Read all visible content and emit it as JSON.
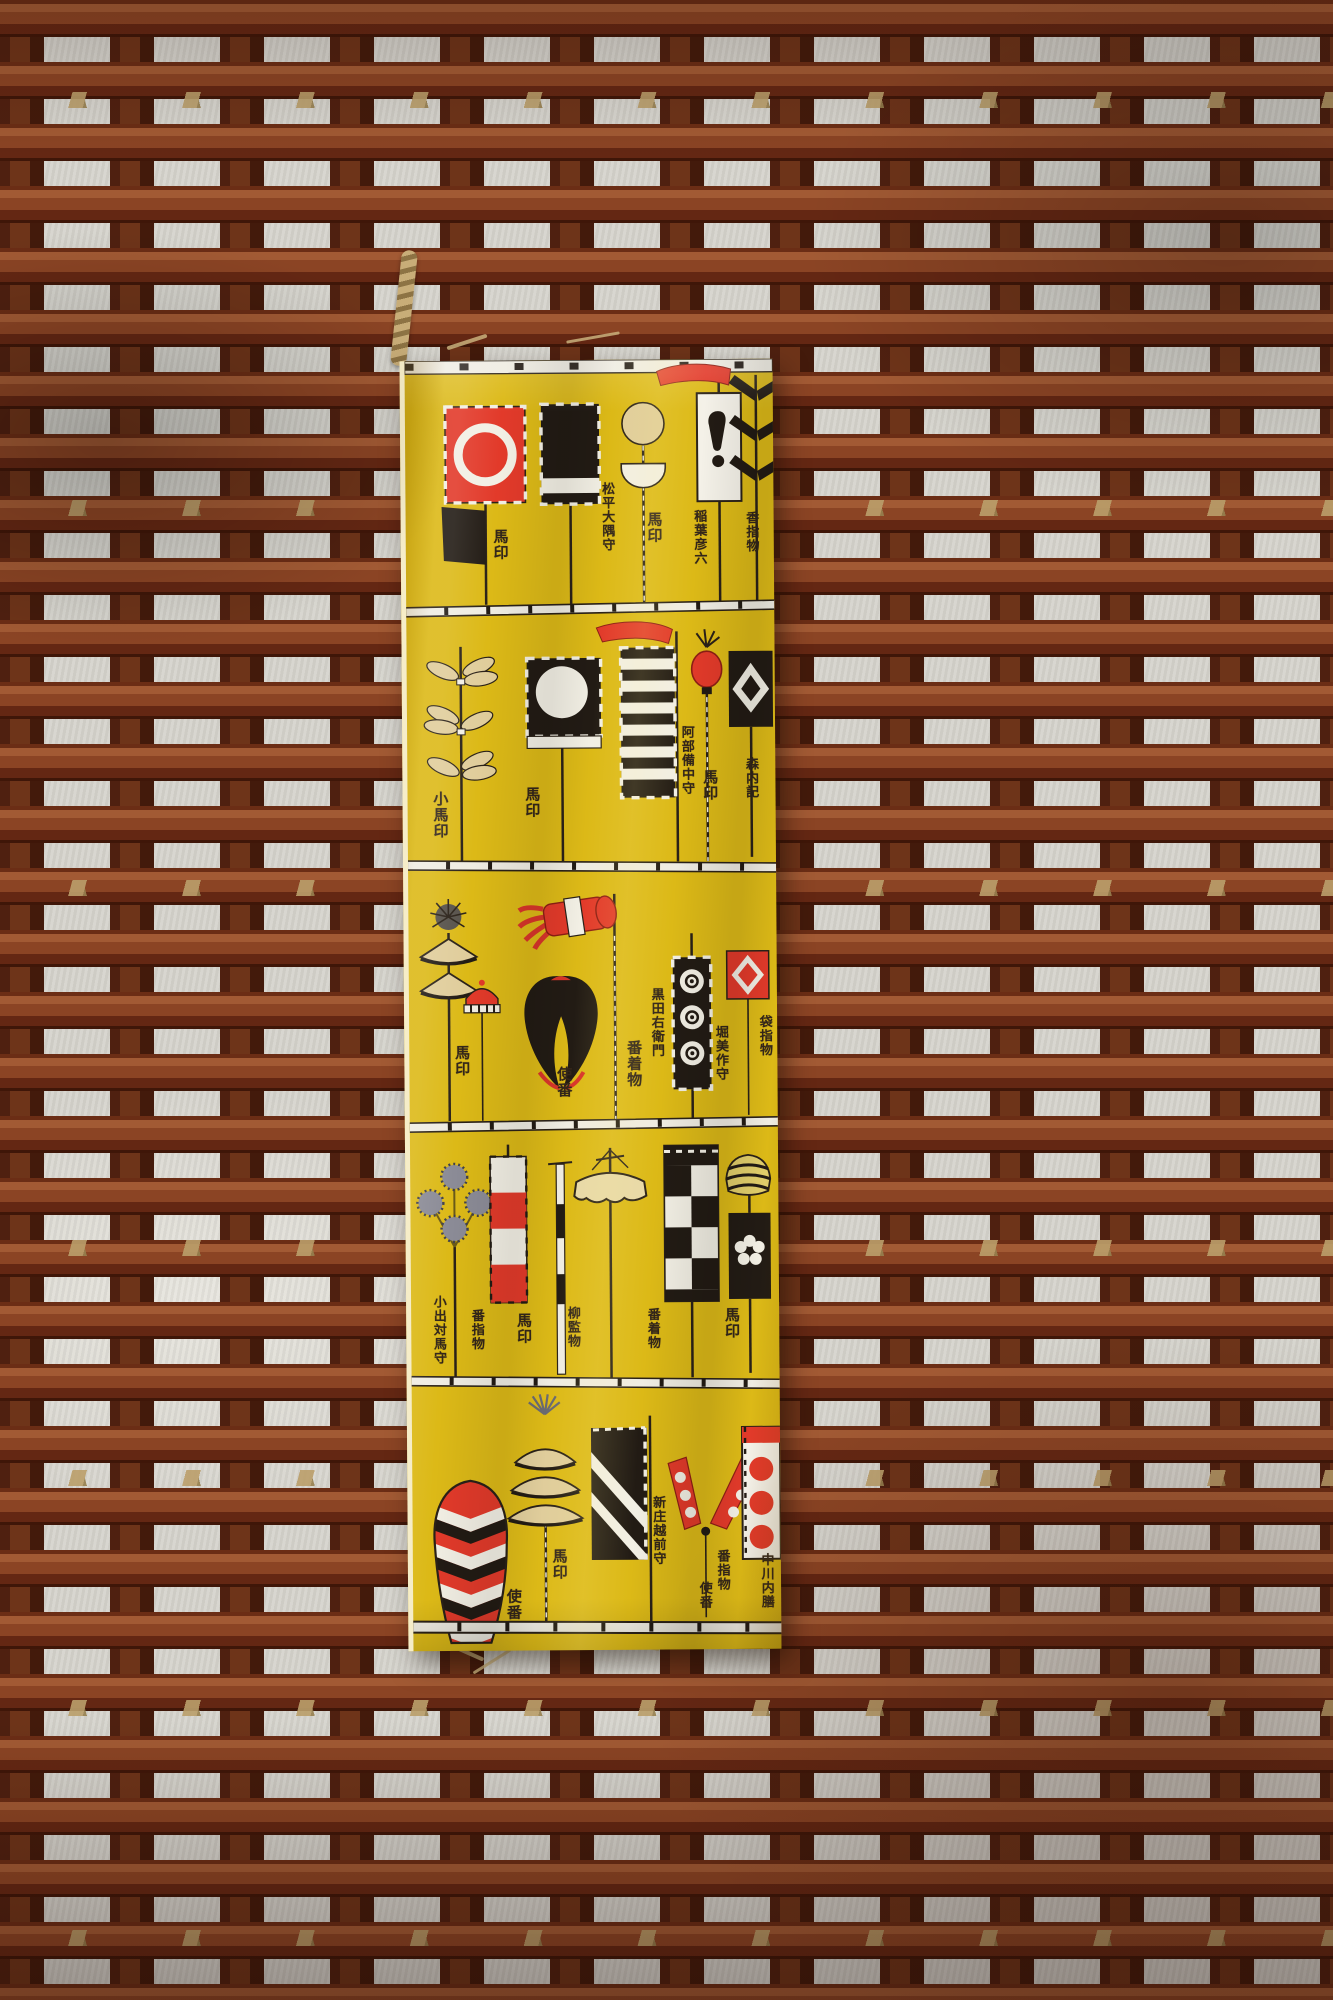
{
  "palette": {
    "fabric_yellow": "#dcb917",
    "banner_red": "#e23a2a",
    "ink_black": "#221b14",
    "cream": "#e0cd9b",
    "paper_white": "#f2efe4",
    "wall_plaster": "#d6d4cd",
    "slat_brown": "#8b4424",
    "post_dark_brown": "#4f2010",
    "rope_straw": "#bb9f6b"
  },
  "fabric": {
    "rows": [
      {
        "items": [
          {
            "motif": "red-circle-banner",
            "label": "馬印"
          },
          {
            "motif": "black-banner-white-stripe",
            "label": "松平大隅守"
          },
          {
            "motif": "ball-and-cup-standard",
            "label": "馬印"
          },
          {
            "motif": "white-banner-red-streamer",
            "label": "稲葉彦六"
          },
          {
            "motif": "black-pine-bars-standard",
            "label": "香指物"
          }
        ]
      },
      {
        "items": [
          {
            "motif": "leaf-spray-standard",
            "label": "小馬印"
          },
          {
            "motif": "black-banner-white-circle",
            "label": "馬印"
          },
          {
            "motif": "striped-banner-red-streamer",
            "label": "阿部備中守"
          },
          {
            "motif": "red-lantern-standard",
            "label": "馬印"
          },
          {
            "motif": "black-banner-white-diamond",
            "label": "森内記"
          }
        ]
      },
      {
        "items": [
          {
            "motif": "pinecone-cone-standard",
            "label": "馬印"
          },
          {
            "motif": "red-cap-standard",
            "label": "使番"
          },
          {
            "motif": "tassel-and-heart-standard",
            "label": "黒田右衛門"
          },
          {
            "motif": "bullseye-banner",
            "label": "番着物"
          },
          {
            "motif": "red-diamond-banner",
            "label": "堀美作守"
          },
          {
            "motif": "side-label",
            "label": "袋指物"
          }
        ]
      },
      {
        "items": [
          {
            "motif": "pompom-flower-standard",
            "label": "小出対馬守"
          },
          {
            "motif": "red-white-block-banner",
            "label": "番指物"
          },
          {
            "motif": "segmented-pole-standard",
            "label": "馬印"
          },
          {
            "motif": "cream-canopy-standard",
            "label": "柳監物"
          },
          {
            "motif": "checkered-banner",
            "label": "番着物"
          },
          {
            "motif": "plum-blossom-banner",
            "label": "馬印"
          }
        ]
      },
      {
        "items": [
          {
            "motif": "chevron-cap-standard",
            "label": "使番"
          },
          {
            "motif": "triple-umbrella-standard",
            "label": "馬印"
          },
          {
            "motif": "diagonal-stripe-banner",
            "label": "新庄越前守"
          },
          {
            "motif": "red-strap-tassel-standard",
            "label": "番指物"
          },
          {
            "motif": "three-circle-banner",
            "label": "使番"
          },
          {
            "motif": "side-label",
            "label": "中川内膳"
          }
        ]
      }
    ]
  }
}
